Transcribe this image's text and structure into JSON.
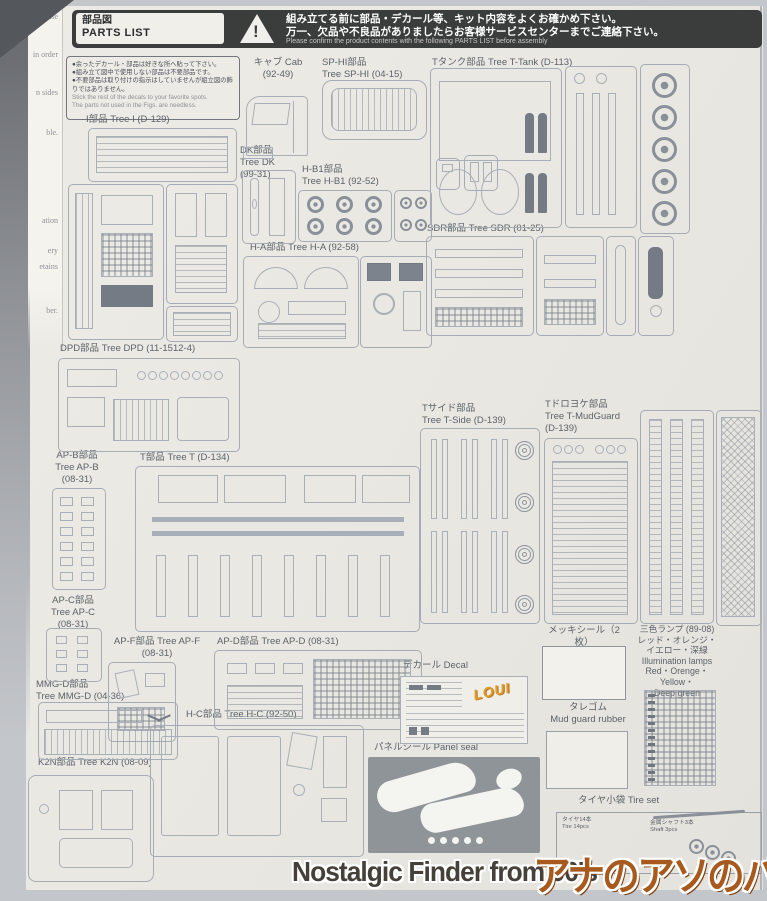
{
  "photo": {
    "edge_fragments": [
      "n case",
      "in order",
      "n sides",
      "ble.",
      "ation",
      "ery",
      "etains",
      "ber."
    ]
  },
  "header": {
    "title_jp": "部品図",
    "title_en": "PARTS LIST",
    "warning_icon": "!",
    "warning_line1": "組み立てる前に部品・デカール等、キット内容をよくお確かめ下さい。",
    "warning_line2": "万一、欠品や不良品がありましたらお客様サービスセンターまでご連絡下さい。",
    "warning_line3": "Please confirm the product contents with the following PARTS LIST before assembly"
  },
  "notes": {
    "jp1": "●余ったデカール・部品は好きな所へ貼って下さい。",
    "jp2": "●組み立て図中で使用しない部品は不要部品です。",
    "jp3": "●不要部品は取り付けの指示はしていませんが組立図の飾りではありません。",
    "en1": "Stick the rest of the decals to your favorite spots.",
    "en2": "The parts not used in the Figs. are needless."
  },
  "trees": {
    "i": {
      "label": "I部品 Tree I (D-129)"
    },
    "cab": {
      "label": "キャブ Cab\n(92-49)"
    },
    "sp_hi": {
      "label": "SP-HI部品\nTree SP-HI (04-15)"
    },
    "t_tank": {
      "label": "Tタンク部品 Tree T-Tank (D-113)"
    },
    "dk": {
      "label": "DK部品\nTree DK\n(99-31)"
    },
    "h_b1": {
      "label": "H-B1部品\nTree H-B1 (92-52)"
    },
    "sdr": {
      "label": "SDR部品 Tree SDR (01-25)"
    },
    "h_a": {
      "label": "H-A部品 Tree H-A (92-58)"
    },
    "dpd": {
      "label": "DPD部品 Tree DPD (11-1512-4)"
    },
    "t_side": {
      "label": "Tサイド部品\nTree T-Side (D-139)"
    },
    "t_mudguard": {
      "label": "Tドロヨケ部品\nTree T-MudGuard\n(D-139)"
    },
    "ap_b": {
      "label": "AP-B部品\nTree AP-B\n(08-31)"
    },
    "t": {
      "label": "T部品 Tree T (D-134)"
    },
    "ap_c": {
      "label": "AP-C部品\nTree AP-C\n(08-31)"
    },
    "ap_f": {
      "label": "AP-F部品 Tree AP-F\n(08-31)"
    },
    "ap_d": {
      "label": "AP-D部品 Tree AP-D (08-31)"
    },
    "mmg_d": {
      "label": "MMG-D部品\nTree MMG-D (04-36)"
    },
    "h_c": {
      "label": "H-C部品 Tree H-C (92-50)"
    },
    "k2n": {
      "label": "K2N部品 Tree K2N (08-09)"
    }
  },
  "extras": {
    "decal": "デカール Decal",
    "decal_logo": "LOUI",
    "plating": "メッキシール（2枚）\nPlating seal 2pcs.",
    "lamps": "三色ランプ (89-08)\nレッド・オレンジ・\nイエロー・深緑\nIllumination lamps\nRed・Orenge・Yellow・\nDeep green",
    "mudflap": "タレゴム\nMud guard rubber",
    "panel_seal": "パネルシール Panel seal",
    "tire_set": "タイヤ小袋 Tire set",
    "tire_note": "タイヤ14本\nTire 14pcs",
    "shaft_note": "金属シャフト3本\nShaft 3pcs"
  },
  "watermark": {
    "text": "Nostalgic Finder from 90's",
    "logo": "アナのアソのバー"
  },
  "colors": {
    "banner_bg": "#3b3c3c",
    "paper": "#eae8e2",
    "line_art": "#a6acb5",
    "logo_brown": "#a85a1e"
  }
}
